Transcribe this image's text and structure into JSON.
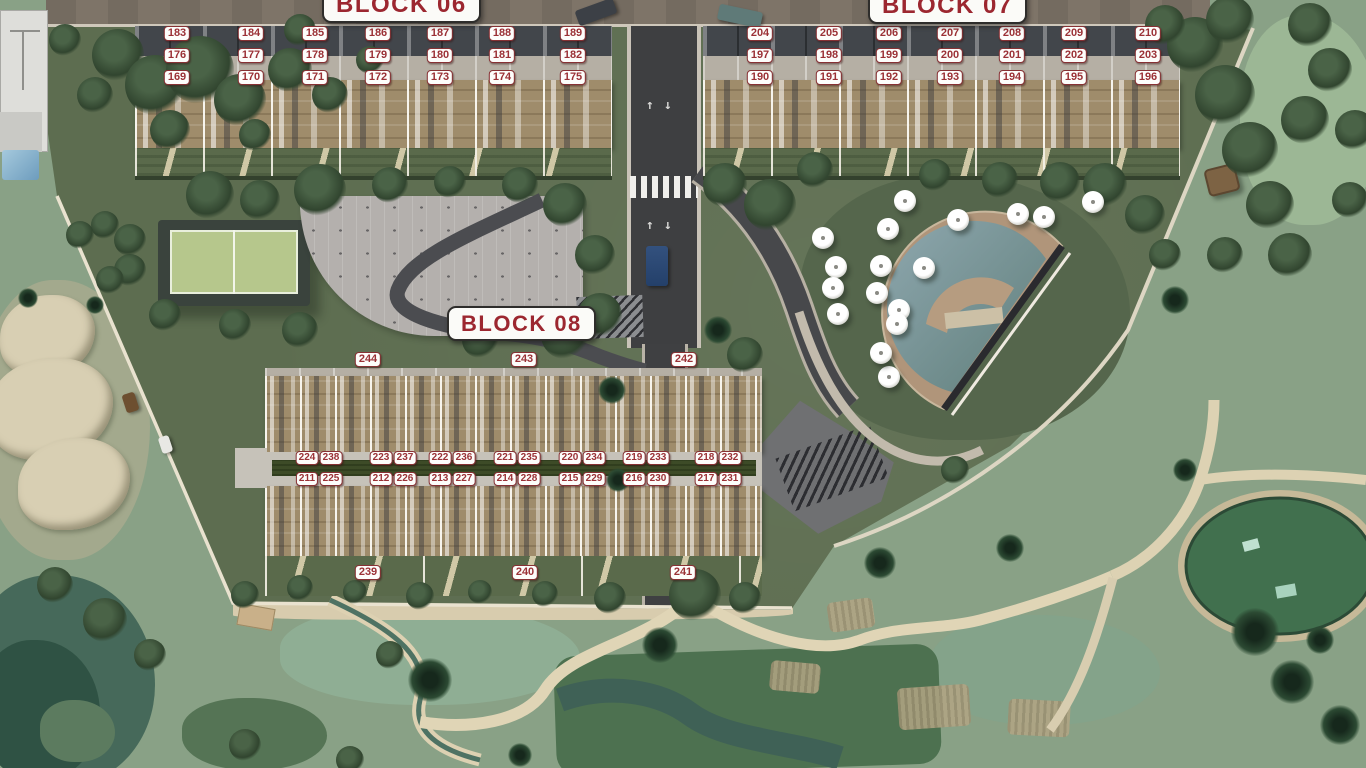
{
  "blocks": {
    "block06": {
      "label": "BLOCK 06",
      "rows": [
        [
          "183",
          "184",
          "185",
          "186",
          "187",
          "188",
          "189"
        ],
        [
          "176",
          "177",
          "178",
          "179",
          "180",
          "181",
          "182"
        ],
        [
          "169",
          "170",
          "171",
          "172",
          "173",
          "174",
          "175"
        ]
      ]
    },
    "block07": {
      "label": "BLOCK 07",
      "rows": [
        [
          "204",
          "205",
          "206",
          "207",
          "208",
          "209",
          "210"
        ],
        [
          "197",
          "198",
          "199",
          "200",
          "201",
          "202",
          "203"
        ],
        [
          "190",
          "191",
          "192",
          "193",
          "194",
          "195",
          "196"
        ]
      ]
    },
    "block08": {
      "label": "BLOCK 08",
      "top_row": [
        "244",
        "243",
        "242"
      ],
      "upper_pairs": [
        [
          "224",
          "238"
        ],
        [
          "223",
          "237"
        ],
        [
          "222",
          "236"
        ],
        [
          "221",
          "235"
        ],
        [
          "220",
          "234"
        ],
        [
          "219",
          "233"
        ],
        [
          "218",
          "232"
        ]
      ],
      "lower_pairs": [
        [
          "211",
          "225"
        ],
        [
          "212",
          "226"
        ],
        [
          "213",
          "227"
        ],
        [
          "214",
          "228"
        ],
        [
          "215",
          "229"
        ],
        [
          "216",
          "230"
        ],
        [
          "217",
          "231"
        ]
      ],
      "bottom_row": [
        "239",
        "240",
        "241"
      ]
    }
  },
  "amenities": {
    "pool": "swimming-pool",
    "padel_court": "padel-court",
    "outdoor_gym": "outdoor-gym-area",
    "parking": "parking-lot",
    "golf": "golf-course",
    "pond": "pond",
    "umbrellas": "pool-umbrellas"
  },
  "colors": {
    "plate_text": "#9b3136",
    "plate_bg": "#fdfdfb",
    "plate_border": "#873134",
    "label_text": "#9c2730",
    "label_border": "#2e2d2b",
    "road": "#3e3f41",
    "pool_water": "#7d98a0",
    "deck_wood": "#9f8c6b",
    "golf_green": "#89a186",
    "dev_green": "#5d6d50"
  }
}
